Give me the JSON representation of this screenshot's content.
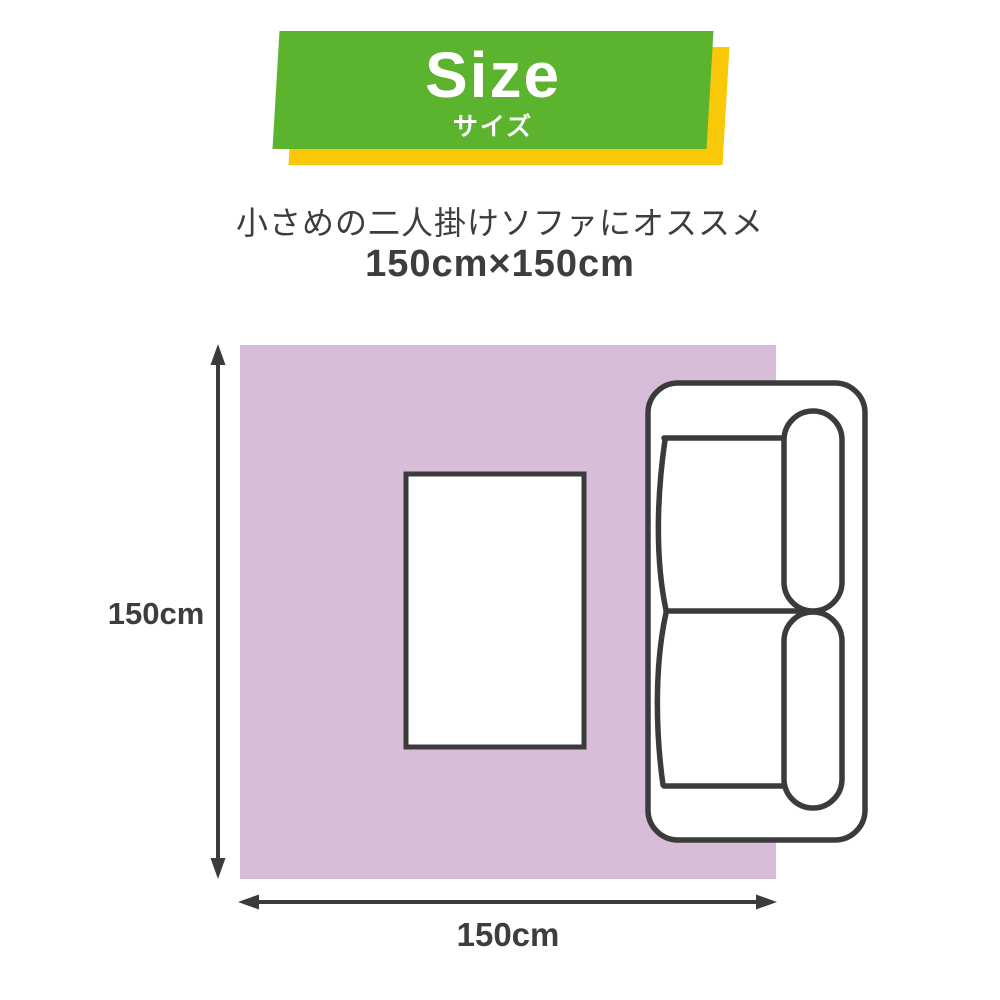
{
  "banner": {
    "title": "Size",
    "subtitle": "サイズ"
  },
  "description": {
    "line1": "小さめの二人掛けソファにオススメ",
    "line2": "150cm×150cm"
  },
  "diagram": {
    "height_label": "150cm",
    "width_label": "150cm",
    "rug_size": "150cm×150cm",
    "items": [
      "rug",
      "low-table",
      "two-seater-sofa"
    ]
  },
  "colors": {
    "banner-green": "#5cb32e",
    "banner-yellow": "#f9c808",
    "rug-pink": "#d8bdd9",
    "outline-dark": "#3b3b3b",
    "text-dark": "#3d3d3d"
  }
}
